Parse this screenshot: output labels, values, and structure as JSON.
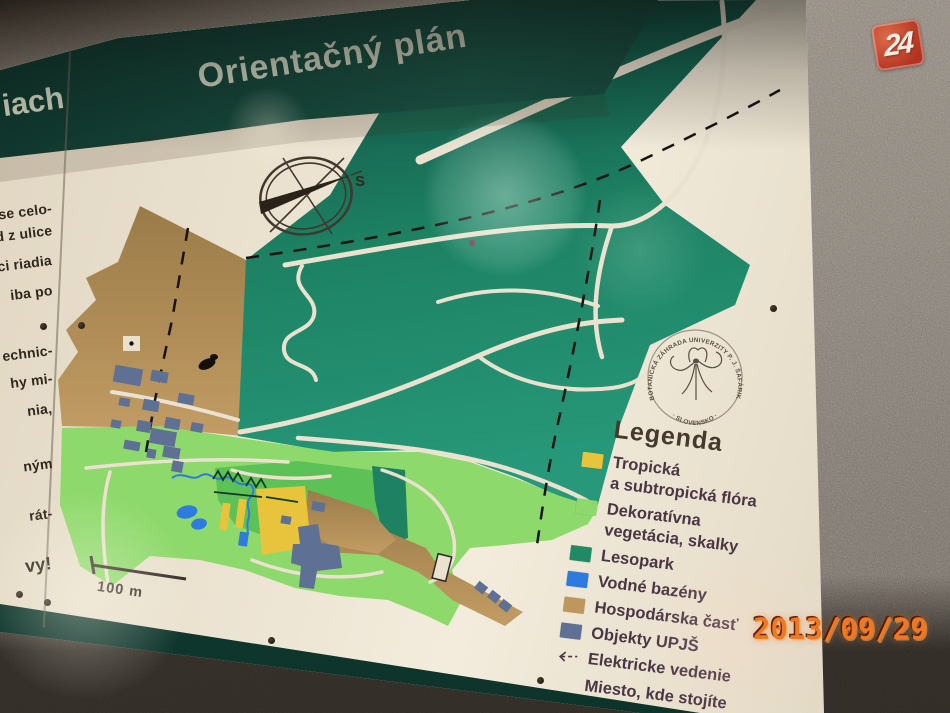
{
  "photo": {
    "watermark": "24",
    "timestamp": "2013/09/29"
  },
  "sign": {
    "title": "Orientačný plán",
    "left_panel": {
      "header_fragment": "iach",
      "lines": [
        "ase celo-",
        "d z ulice",
        "ci riadia",
        "iba po",
        "echnic-",
        "hy mi-",
        "nia,",
        "ným",
        "rát-",
        "vy!"
      ]
    },
    "compass": {
      "label": "S"
    },
    "scale": {
      "label": "100 m"
    },
    "logo": {
      "arc_top": "BOTANICKÁ ZÁHRADA UNIVERZITY P. J. ŠAFÁRIKA KOŠICE",
      "arc_bottom": "· SLOVENSKO ·"
    },
    "legend": {
      "title": "Legenda",
      "items": [
        {
          "color": "#e7c43c",
          "line1": "Tropická",
          "line2": "a subtropická flóra"
        },
        {
          "color": "#8ed96b",
          "line1": "Dekoratívna",
          "line2": "vegetácia, skalky"
        },
        {
          "color": "#208a66",
          "line1": "Lesopark",
          "line2": ""
        },
        {
          "color": "#2e7be0",
          "line1": "Vodné bazény",
          "line2": ""
        },
        {
          "color": "#bd975d",
          "line1": "Hospodárska časť",
          "line2": ""
        },
        {
          "color": "#5e7093",
          "line1": "Objekty UPJŠ",
          "line2": ""
        },
        {
          "color": "",
          "symbol": "dashed-arrow",
          "line1": "Elektricke vedenie",
          "line2": ""
        },
        {
          "color": "",
          "symbol": "none",
          "line1": "Miesto, kde stojíte",
          "line2": ""
        }
      ]
    }
  }
}
